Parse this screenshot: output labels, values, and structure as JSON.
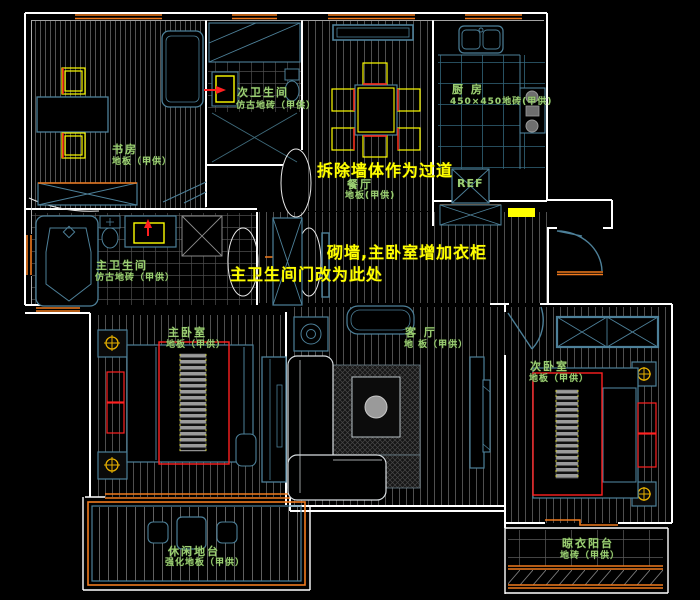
{
  "drawing_type": "apartment-floor-plan-cad",
  "colors": {
    "background": "#000000",
    "wall": "#ffffff",
    "fixture": "#4d8099",
    "window": "#f07a1e",
    "room_label": "#9ccf73",
    "annotation": "#ffff00",
    "accent_red": "#ff2020",
    "furniture_yellow": "#ffff00"
  },
  "rooms": {
    "study": {
      "name": "书房",
      "floor": "地板（甲供）"
    },
    "secondary_bathroom": {
      "name": "次卫生间",
      "floor": "仿古地砖（甲供）"
    },
    "dining_room": {
      "name": "餐厅",
      "floor": "地板(甲供)"
    },
    "kitchen": {
      "name": "厨 房",
      "floor": "450×450地砖(甲供)"
    },
    "master_bathroom": {
      "name": "主卫生间",
      "floor": "仿古地砖（甲供）"
    },
    "master_bedroom": {
      "name": "主卧室",
      "floor": "地板（甲供）"
    },
    "living_room": {
      "name": "客 厅",
      "floor": "地 板（甲供）"
    },
    "secondary_bedroom": {
      "name": "次卧室",
      "floor": "地板（甲供）"
    },
    "leisure_platform": {
      "name": "休闲地台",
      "floor": "强化地板（甲供）"
    },
    "drying_balcony": {
      "name": "晾衣阳台",
      "floor": "地砖（甲供）"
    }
  },
  "appliances": {
    "fridge_label": "REF"
  },
  "annotations": {
    "demolish_wall": "拆除墙体作为过道",
    "build_wall": "砌墙,主卧室增加衣柜",
    "relocate_door": "主卫生间门改为此处"
  }
}
